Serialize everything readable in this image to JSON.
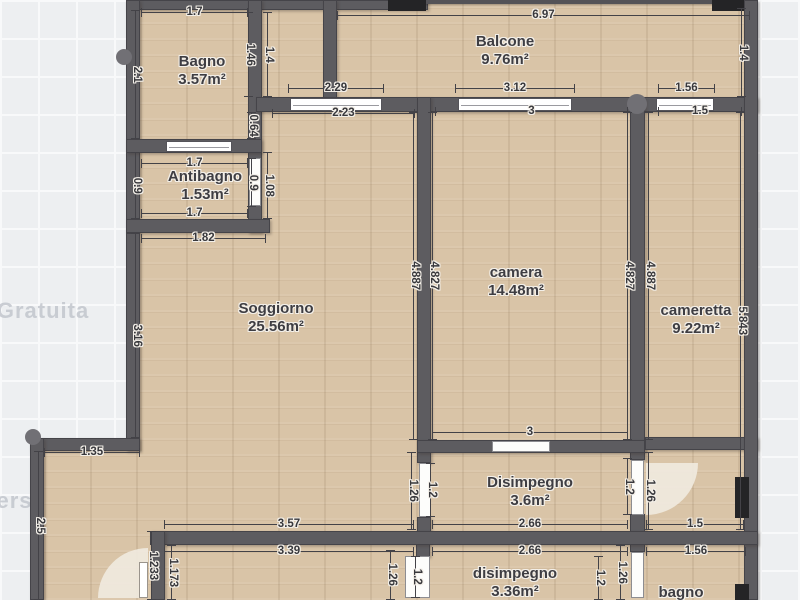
{
  "watermark": {
    "text": "Versione Gratuita"
  },
  "rooms": [
    {
      "name": "Bagno",
      "area": "3.57m²"
    },
    {
      "name": "Antibagno",
      "area": "1.53m²"
    },
    {
      "name": "Balcone",
      "area": "9.76m²"
    },
    {
      "name": "Soggiorno",
      "area": "25.56m²"
    },
    {
      "name": "camera",
      "area": "14.48m²"
    },
    {
      "name": "cameretta",
      "area": "9.22m²"
    },
    {
      "name": "Disimpegno",
      "area": "3.6m²"
    },
    {
      "name": "disimpegno",
      "area": "3.36m²"
    },
    {
      "name": "bagno",
      "area": ""
    }
  ],
  "dims": {
    "bagno_w": "1.7",
    "bagno_h": "2.1",
    "strip_l": "1.46",
    "strip_r": "1.4",
    "balcone_w": "6.97",
    "balcone_h": "1.4",
    "win1_out": "2.29",
    "win1_in": "2.23",
    "win2_out": "3.12",
    "win2_in": "3",
    "win3_out": "1.56",
    "win3_in": "1.5",
    "wall_gap": "0.64",
    "anti_w": "1.7",
    "anti_l": "0.9",
    "anti_door": "0.9",
    "anti_wall": "1.08",
    "anti_b": "1.7",
    "sogg_top": "1.82",
    "sogg_left": "3.16",
    "cam_lwall_out": "4.887",
    "cam_lwall_in": "4.827",
    "cam_rwall_in": "4.827",
    "cam_rwall_out": "4.887",
    "camtta_h": "5.843",
    "cam_bottom": "3",
    "step_w": "1.35",
    "step_h": "2.5",
    "dis_ldoor_out": "1.26",
    "dis_ldoor_in": "1.2",
    "dis_rdoor_in": "1.2",
    "dis_rdoor_out": "1.26",
    "dis_b_out": "2.66",
    "dis_b_in": "2.66",
    "cuc_out": "3.57",
    "cuc_in": "3.39",
    "hall_out": "1.233",
    "hall_in": "1.173",
    "low1_out": "1.26",
    "low1_in": "1.2",
    "low2_in": "1.2",
    "low2_out": "1.26",
    "bagno2_in": "1.5",
    "bagno2_out": "1.56"
  },
  "colors": {
    "floor": "#d9c4a7",
    "wall": "#5d5c60",
    "background": "#edeff1",
    "pillar": "#242426",
    "dim_text": "#38383c"
  }
}
